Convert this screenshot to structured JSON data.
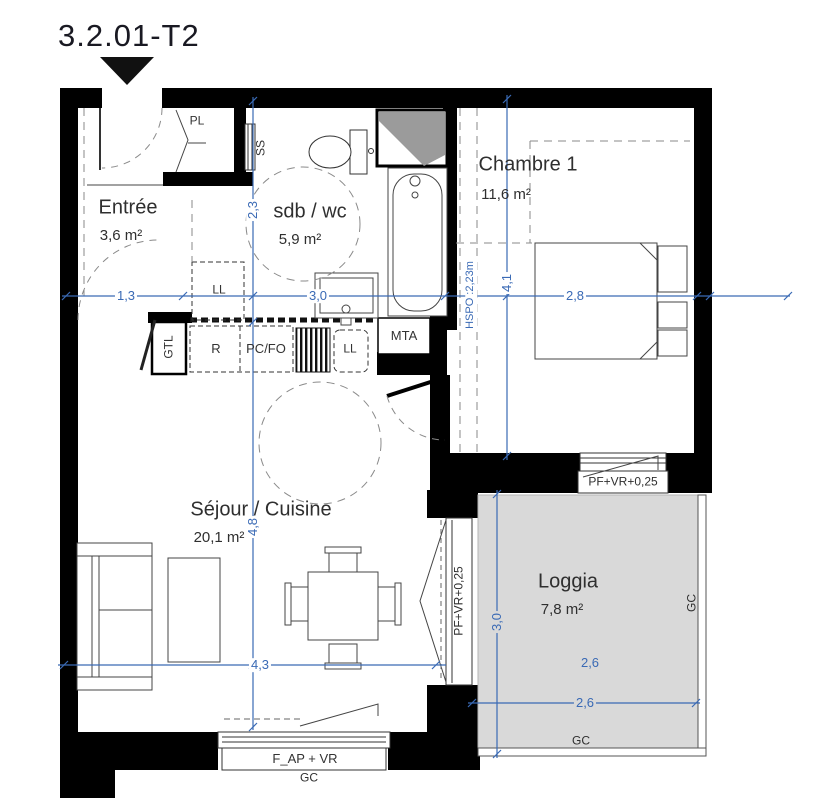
{
  "title": "3.2.01-T2",
  "rooms": {
    "entree": {
      "name": "Entrée",
      "area": "3,6 m²"
    },
    "sdb": {
      "name": "sdb / wc",
      "area": "5,9 m²"
    },
    "chambre": {
      "name": "Chambre 1",
      "area": "11,6 m²"
    },
    "sejour": {
      "name": "Séjour / Cuisine",
      "area": "20,1 m²"
    },
    "loggia": {
      "name": "Loggia",
      "area": "7,8 m²"
    }
  },
  "fixtures": {
    "pl": "PL",
    "ss": "SS",
    "ll_hall": "LL",
    "gtl": "GTL",
    "fridge": "R",
    "cooktop": "PC/FO",
    "washer": "LL",
    "mta": "MTA"
  },
  "windows": {
    "chambre": "PF+VR+0,25",
    "sejour": "PF+VR+0,25",
    "bottom": "F_AP + VR"
  },
  "gc": {
    "right": "GC",
    "loggia_bottom": "GC",
    "below_window": "GC"
  },
  "dims": {
    "entree_w": "1,3",
    "sdb_w": "3,0",
    "chambre_w": "2,8",
    "sdb_h": "2,3",
    "chambre_h": "4,1",
    "sejour_h": "4,8",
    "sejour_w": "4,3",
    "loggia_w_upper": "2,6",
    "loggia_w_lower": "2,6",
    "loggia_h": "3,0",
    "hspo": "HSPO :2,23m"
  },
  "colors": {
    "dim_blue": "#3a6ab5",
    "wall_black": "#000000",
    "loggia_fill": "#d9d9d9",
    "duct_gray": "#9b9b9b"
  }
}
